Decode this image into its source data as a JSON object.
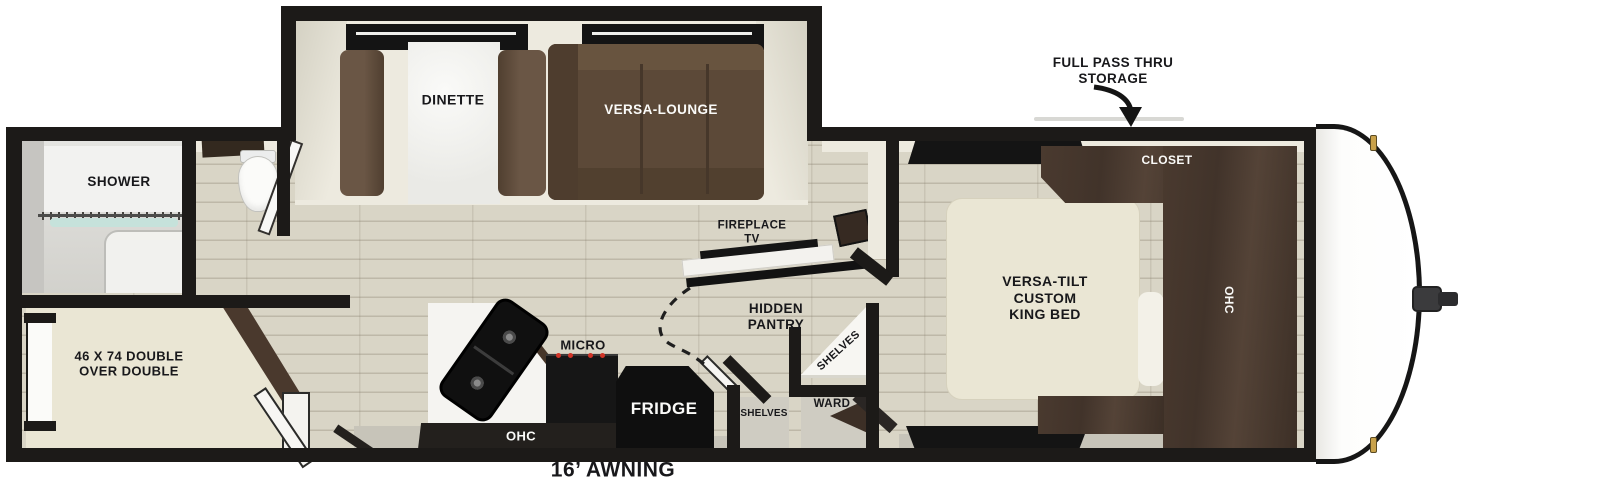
{
  "title": "Travel trailer floor plan",
  "labels": {
    "pass_thru_line1": "FULL PASS THRU",
    "pass_thru_line2": "STORAGE",
    "dinette": "DINETTE",
    "versa_lounge": "VERSA-LOUNGE",
    "shower": "SHOWER",
    "bunk_line1": "46 X 74 DOUBLE",
    "bunk_line2": "OVER DOUBLE",
    "fireplace_line1": "FIREPLACE",
    "fireplace_line2": "TV",
    "hidden_pantry_line1": "HIDDEN",
    "hidden_pantry_line2": "PANTRY",
    "micro": "MICRO",
    "fridge": "FRIDGE",
    "kitchen_ohc": "OHC",
    "shelves_alcove": "SHELVES",
    "shelves_corner": "SHELVES",
    "ward": "WARD",
    "closet": "CLOSET",
    "king_bed_line1": "VERSA-TILT",
    "king_bed_line2": "CUSTOM",
    "king_bed_line3": "KING BED",
    "bedroom_ohc": "OHC",
    "awning": "16’ AWNING"
  },
  "colors": {
    "wall": "#1c1a18",
    "floor_wood": "#d9d5c6",
    "furniture_brown": "#5c4938",
    "cabinet_brown": "#43352b",
    "bed_cream": "#eae6d4",
    "counter_white": "#f5f4f1",
    "appliance_black": "#121212",
    "clearance_light_gold": "#c9a24b",
    "shower_glass_teal": "#c6e2db"
  }
}
